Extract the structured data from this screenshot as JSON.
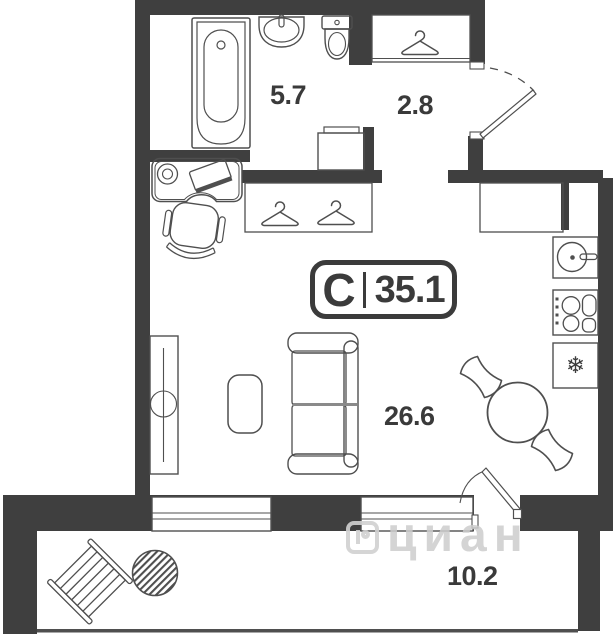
{
  "plan_badge": {
    "type": "С",
    "total_area": "35.1"
  },
  "areas": {
    "bathroom": "5.7",
    "hallway": "2.8",
    "living_room": "26.6",
    "balcony": "10.2"
  },
  "watermark": {
    "text": "циан"
  },
  "icons": {
    "freezer": "❄"
  },
  "colors": {
    "wall": "#3f3f3f",
    "outline": "#4f4f4f",
    "label_text": "#3a3a3a",
    "watermark": "#d0d0d0"
  }
}
